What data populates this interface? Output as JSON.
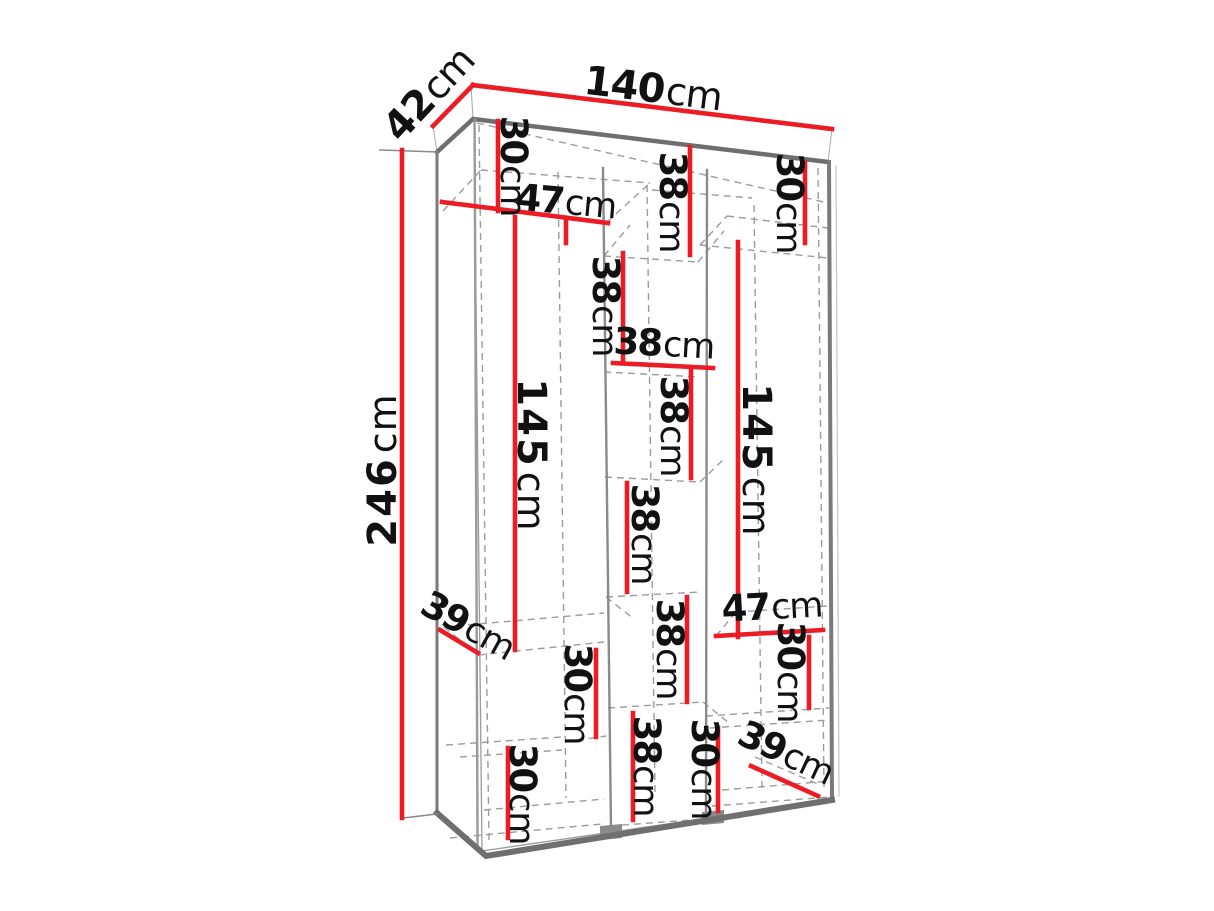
{
  "diagram": {
    "subject": "wardrobe-dimension-diagram",
    "unit": "cm",
    "colors": {
      "dimension_line": "#EC1C24",
      "label_text": "#111111",
      "edge_dark": "#6F6F6F",
      "edge_mid": "#8A8A8A",
      "dashed_line": "#9C9C9C",
      "background": "#FFFFFF"
    },
    "overall": {
      "width": "140cm",
      "depth": "42cm",
      "height": "246cm"
    }
  },
  "labels": [
    {
      "id": "overall-depth",
      "value": "42",
      "unit": "cm"
    },
    {
      "id": "overall-width",
      "value": "140",
      "unit": "cm"
    },
    {
      "id": "overall-height",
      "value": "246",
      "unit": "cm"
    },
    {
      "id": "left-top-section",
      "value": "30",
      "unit": "cm"
    },
    {
      "id": "left-column-width",
      "value": "47",
      "unit": "cm"
    },
    {
      "id": "left-hanging-height",
      "value": "145",
      "unit": "cm"
    },
    {
      "id": "left-shelf-depth",
      "value": "39",
      "unit": "cm"
    },
    {
      "id": "left-lower-section-1",
      "value": "30",
      "unit": "cm"
    },
    {
      "id": "left-lower-section-2",
      "value": "30",
      "unit": "cm"
    },
    {
      "id": "center-cubby-1",
      "value": "38",
      "unit": "cm"
    },
    {
      "id": "center-cubby-2",
      "value": "38",
      "unit": "cm"
    },
    {
      "id": "center-column-width",
      "value": "38",
      "unit": "cm"
    },
    {
      "id": "center-cubby-3",
      "value": "38",
      "unit": "cm"
    },
    {
      "id": "center-cubby-4",
      "value": "38",
      "unit": "cm"
    },
    {
      "id": "center-cubby-5",
      "value": "38",
      "unit": "cm"
    },
    {
      "id": "center-cubby-6",
      "value": "38",
      "unit": "cm"
    },
    {
      "id": "right-top-section",
      "value": "30",
      "unit": "cm"
    },
    {
      "id": "right-hanging-height",
      "value": "145",
      "unit": "cm"
    },
    {
      "id": "right-column-width",
      "value": "47",
      "unit": "cm"
    },
    {
      "id": "right-lower-section-1",
      "value": "30",
      "unit": "cm"
    },
    {
      "id": "right-lower-section-2",
      "value": "30",
      "unit": "cm"
    },
    {
      "id": "right-shelf-depth",
      "value": "39",
      "unit": "cm"
    }
  ]
}
